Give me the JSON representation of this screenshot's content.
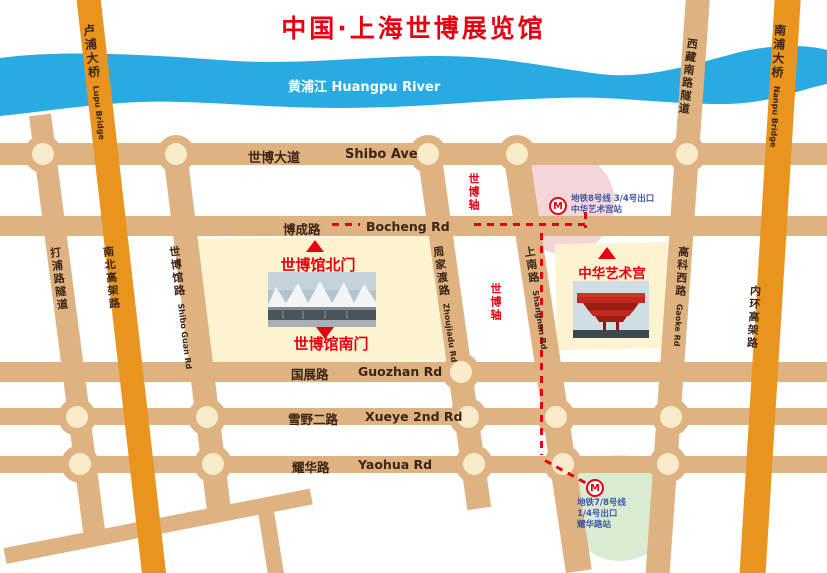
{
  "title": "中国·上海世博展览馆",
  "river_label": "黄浦江 Huangpu River",
  "h_roads": [
    {
      "cn": "世博大道",
      "en": "Shibo Ave"
    },
    {
      "cn": "博成路",
      "en": "Bocheng Rd"
    },
    {
      "cn": "国展路",
      "en": "Guozhan Rd"
    },
    {
      "cn": "雪野二路",
      "en": "Xueye 2nd Rd"
    },
    {
      "cn": "耀华路",
      "en": "Yaohua Rd"
    }
  ],
  "v_roads": [
    {
      "cn": "打浦路隧道",
      "en": ""
    },
    {
      "cn": "卢浦大桥",
      "en": "Lupu Bridge"
    },
    {
      "cn": "南北高架路",
      "en": ""
    },
    {
      "cn": "世博馆路",
      "en": "Shibo Guan Rd"
    },
    {
      "cn": "周家渡路",
      "en": "Zhoujiadu Rd"
    },
    {
      "cn": "上南路",
      "en": "Shangnan Rd"
    },
    {
      "cn": "高科西路",
      "en": "Gaoke Rd"
    },
    {
      "cn": "西藏南路隧道",
      "en": ""
    },
    {
      "cn": "南浦大桥",
      "en": "Nanpu Bridge"
    },
    {
      "cn": "内环高架路",
      "en": ""
    }
  ],
  "expo_axis_label": "世博轴",
  "poi": {
    "expo_north_gate": "世博馆北门",
    "expo_south_gate": "世博馆南门",
    "art_palace": "中华艺术宫"
  },
  "metro_line8": {
    "logo": "M",
    "l1": "地铁8号线 3/4号出口",
    "l2": "中华艺术宫站"
  },
  "metro_line78": {
    "logo": "M",
    "l1": "地铁7/8号线",
    "l2": "1/4号出口",
    "l3": "耀华路站"
  },
  "colors": {
    "road_tan": "#dfb282",
    "road_orange": "#e8941f",
    "river_blue": "#29abe2",
    "accent_red": "#e60012",
    "metro_text_blue": "#3d56a6",
    "intersection_fill": "#f8ecca",
    "venue_block_yellow": "#fdf3d0",
    "metro8_area_pink": "#f3d6da",
    "metro78_area_green": "#d9ecd3"
  }
}
